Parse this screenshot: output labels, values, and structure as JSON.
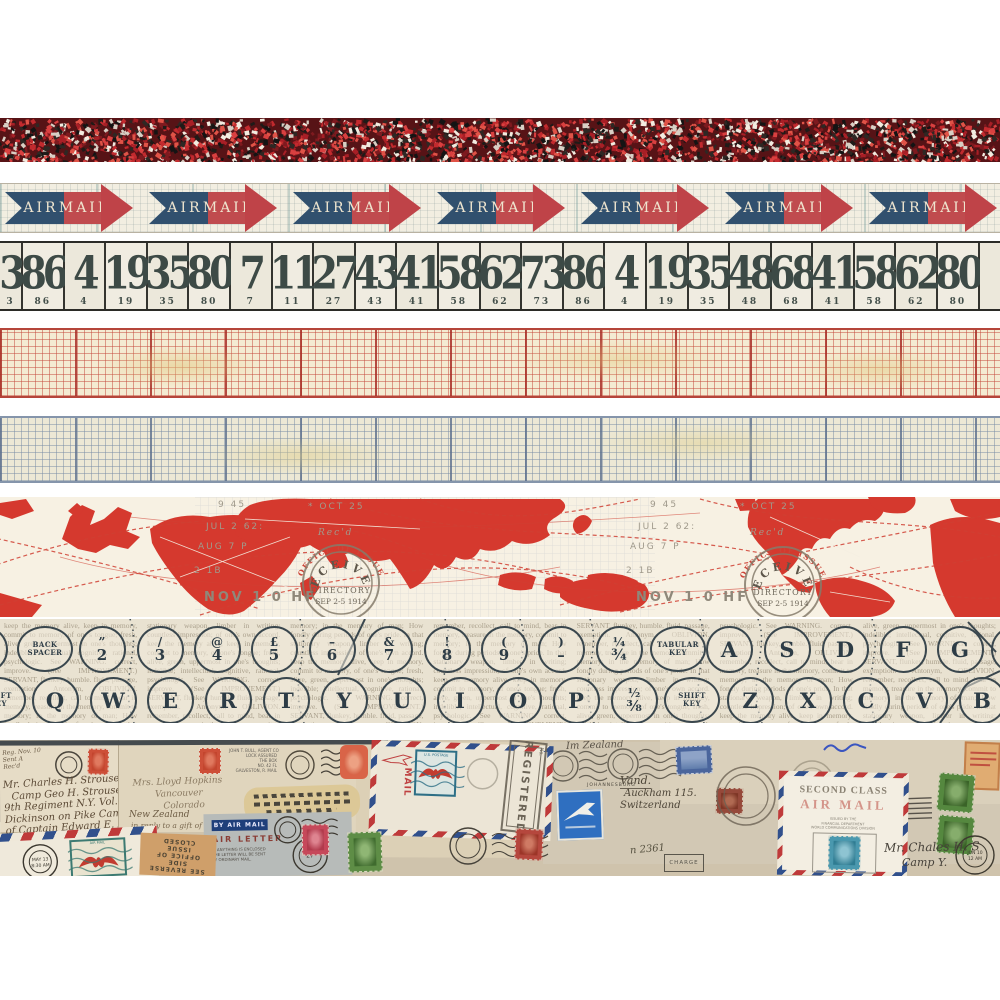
{
  "product": {
    "title": "Vintage correspondence design tape strips"
  },
  "strips": {
    "confetti": {
      "base_color": "#571316",
      "speckle_colors": [
        "#c22a2e",
        "#a81f26",
        "#e05347",
        "#141414",
        "#2e2824",
        "#f2ece0",
        "#d8cfc4",
        "#7e1a1f",
        "#d94040",
        "#1f1b18"
      ]
    },
    "airmail": {
      "air_label": "AIR",
      "mail_label": "MAIL",
      "blue": "#31506e",
      "red": "#c04b4e",
      "head_red": "#bf4348",
      "tips": [
        133,
        277,
        421,
        565,
        709,
        853,
        997
      ]
    },
    "numbers": {
      "values": [
        "3",
        "86",
        "4",
        "19",
        "35",
        "80",
        "7",
        "11",
        "27",
        "43",
        "41",
        "58",
        "62",
        "73",
        "86",
        "4",
        "19",
        "35",
        "48",
        "68",
        "41",
        "58",
        "62",
        "80",
        ""
      ]
    },
    "map": {
      "land_color": "#d5392e",
      "stamp": {
        "arc": "OFFICE OF ISSUE",
        "line1": "RECEIVED",
        "line2": "DIRECTORY",
        "line3": "SEP 2-5 1914"
      },
      "cancel_cluster": [
        {
          "text": "9 45",
          "x": 28,
          "y": 10,
          "style": "plain"
        },
        {
          "text": "* OCT 25",
          "x": 118,
          "y": 12,
          "style": "plain"
        },
        {
          "text": "JUL 2 62:",
          "x": 16,
          "y": 32,
          "style": "plain"
        },
        {
          "text": "AUG 7 P",
          "x": 8,
          "y": 52,
          "style": "plain"
        },
        {
          "text": "Rec'd",
          "x": 128,
          "y": 38,
          "style": "italic"
        },
        {
          "text": "2 1B",
          "x": 4,
          "y": 76,
          "style": "plain"
        },
        {
          "text": "NOV 1 0 HF",
          "x": 14,
          "y": 104,
          "style": "bold"
        }
      ],
      "cluster_offsets": [
        190,
        622
      ]
    },
    "typewriter": {
      "top_row": [
        {
          "type": "partial",
          "x": -16
        },
        {
          "type": "label",
          "x": 45,
          "l1": "BACK",
          "l2": "SPACER"
        },
        {
          "type": "combo",
          "x": 102,
          "t": "”",
          "b": "2"
        },
        {
          "type": "combo",
          "x": 160,
          "t": "/",
          "b": "3"
        },
        {
          "type": "combo",
          "x": 217,
          "t": "@",
          "b": "4"
        },
        {
          "type": "combo",
          "x": 274,
          "t": "£",
          "b": "5"
        },
        {
          "type": "combo",
          "x": 332,
          "t": "–",
          "b": "6"
        },
        {
          "type": "combo",
          "x": 389,
          "t": "&",
          "b": "7"
        },
        {
          "type": "combo",
          "x": 447,
          "t": "!",
          "b": "8"
        },
        {
          "type": "combo",
          "x": 504,
          "t": "(",
          "b": "9"
        },
        {
          "type": "combo",
          "x": 561,
          "t": ")",
          "b": "–"
        },
        {
          "type": "combo",
          "x": 619,
          "t": "¼",
          "b": "¾"
        },
        {
          "type": "label",
          "x": 678,
          "l1": "TABULAR",
          "l2": "KEY"
        },
        {
          "type": "letter",
          "x": 729,
          "c": "A"
        },
        {
          "type": "letter",
          "x": 787,
          "c": "S"
        },
        {
          "type": "letter",
          "x": 845,
          "c": "D"
        },
        {
          "type": "letter",
          "x": 903,
          "c": "F"
        },
        {
          "type": "letter",
          "x": 960,
          "c": "G"
        },
        {
          "type": "partial",
          "x": 1014
        }
      ],
      "bottom_row": [
        {
          "type": "label",
          "x": -2,
          "l1": "SHIFT",
          "l2": "KEY"
        },
        {
          "type": "letter",
          "x": 55,
          "c": "Q"
        },
        {
          "type": "letter",
          "x": 113,
          "c": "W"
        },
        {
          "type": "letter",
          "x": 170,
          "c": "E"
        },
        {
          "type": "letter",
          "x": 228,
          "c": "R"
        },
        {
          "type": "letter",
          "x": 286,
          "c": "T"
        },
        {
          "type": "letter",
          "x": 344,
          "c": "Y"
        },
        {
          "type": "letter",
          "x": 402,
          "c": "U"
        },
        {
          "type": "letter",
          "x": 460,
          "c": "I"
        },
        {
          "type": "letter",
          "x": 518,
          "c": "O"
        },
        {
          "type": "letter",
          "x": 576,
          "c": "P"
        },
        {
          "type": "combo",
          "x": 634,
          "t": "½",
          "b": "⅜"
        },
        {
          "type": "label",
          "x": 692,
          "l1": "SHIFT",
          "l2": "KEY"
        },
        {
          "type": "letter",
          "x": 750,
          "c": "Z"
        },
        {
          "type": "letter",
          "x": 808,
          "c": "X"
        },
        {
          "type": "letter",
          "x": 866,
          "c": "C"
        },
        {
          "type": "letter",
          "x": 924,
          "c": "V"
        },
        {
          "type": "letter",
          "x": 982,
          "c": "B"
        }
      ],
      "newsprint": "keep the memory alive, keep in memory, commit to memory, of one's tongue; fresh, alive, green, uppermost in one's thoughts; indelible; intellectual, cognitive, rational, psychologic. See WARNING. correct, improve. (See IMPROVEMENT.) SERVANT, flunkey, humble. fluid, passage, exemption. Antonym, OBLIVION. remember, recollect, call to mind, bear in memory, treasure in the memory, commit to memory; in the memory of man; How fondly during periods of one's pride. In that stationary weapon, limber in writing; countless impression; of one's own accord. "
    },
    "collage": {
      "env1_lines": [
        "Mr. Charles H. Strouse",
        "Camp Geo H. Strouse",
        "9th Regiment N.Y. Vol. P.H.",
        "Dickinson on Pike Camp",
        "of Captain Edward E. B."
      ],
      "env2_lines": [
        "Mrs. Lloyd Hopkins",
        "Vancouver",
        "Colorado"
      ],
      "env2_extra1": "New Zealand",
      "env2_extra2": "in reply to a gift of Chas of your",
      "typed_block": [
        "JOHN T. BULL, AGENT CO",
        "LOCK ASSURED",
        "THE BOX",
        "NO. 42 FL",
        "GALVESTON, R. MAIL"
      ],
      "registered": "REGISTERED",
      "registered_no": "No.",
      "airletter": {
        "by_air_mail": "BY AIR MAIL",
        "title": "AIR LETTER",
        "note1": "IF ANYTHING IS ENCLOSED",
        "note2": "THE LETTER WILL BE SENT",
        "note3": "BY ORDINARY MAIL."
      },
      "second_class": {
        "line1": "SECOND CLASS",
        "line2": "AIR MAIL",
        "note1": "ISSUED BY THE",
        "note2": "FINANCIAL DEPARTMENT",
        "note3": "WORLD COMMUNICATIONS DIVISION"
      },
      "charge_label": "CHARGE",
      "charge_no": "n 2361",
      "stamped_note": [
        "SEE REVERSE SIDE",
        "OFFICE OF ISSUE",
        "CLOSED"
      ],
      "cancel_text": "JOHANNESBURG",
      "hw_top_right": "Im Zealand",
      "hw_right1": "Vand.",
      "hw_right2": "Auckham 115.",
      "hw_right3": "Switzerland",
      "hw_corner1": "Mr. Chales H. S",
      "hw_corner2": "Camp Y.",
      "postmark_may": "MAY 13",
      "postmark_may2": "8:30 AM",
      "postmark_jun": "JUN 10",
      "postmark_jun2": "12 AM",
      "eagle_stamp_label": "AIR MAIL",
      "us_stamp_top": "U.S. POSTAGE",
      "vertical_mail": "MAIL"
    }
  }
}
